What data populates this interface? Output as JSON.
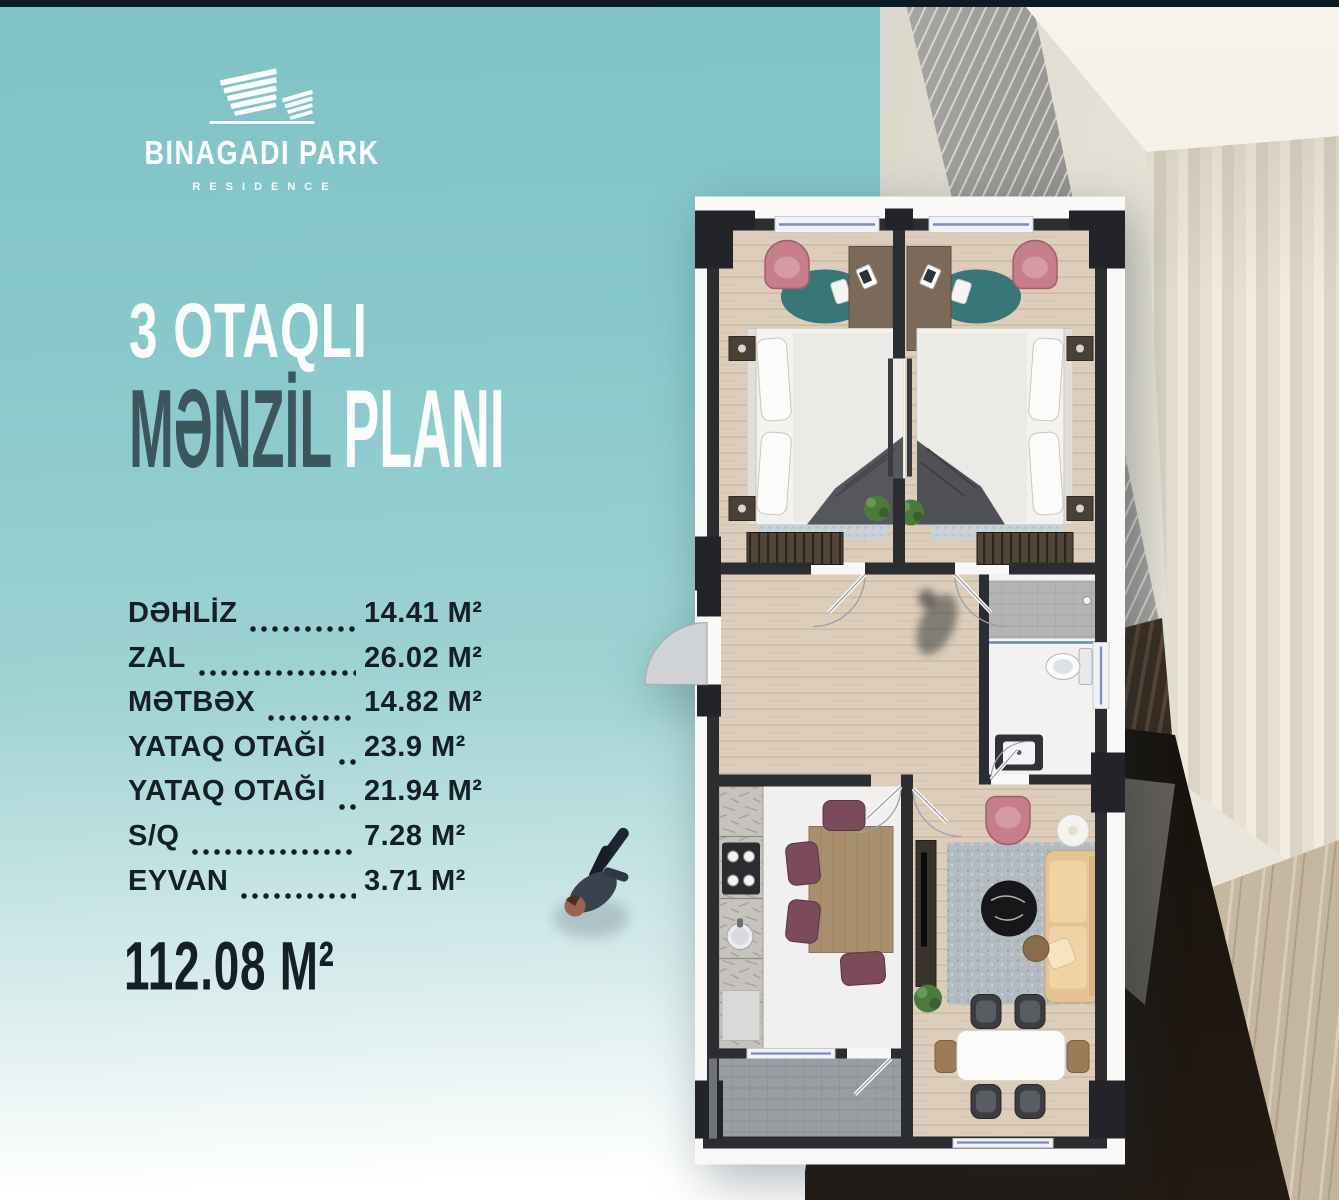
{
  "brand": {
    "name": "BINAGADI PARK",
    "subtitle": "RESIDENCE"
  },
  "headline": {
    "line1": "3 OTAQLI",
    "line2_primary": "MƏNZİL",
    "line2_secondary": "PLANI"
  },
  "rooms": [
    {
      "label": "DƏHLİZ",
      "value": "14.41 M²"
    },
    {
      "label": "ZAL",
      "value": "26.02 M²"
    },
    {
      "label": "MƏTBƏX",
      "value": "14.82 M²"
    },
    {
      "label": "YATAQ OTAĞI",
      "value": "23.9 M²"
    },
    {
      "label": "YATAQ OTAĞI",
      "value": "21.94 M²"
    },
    {
      "label": "S/Q",
      "value": "7.28 M²"
    },
    {
      "label": "EYVAN",
      "value": "3.71 M²"
    }
  ],
  "total": {
    "value": "112.08 M²"
  },
  "colors": {
    "background_teal": "#85c6ca",
    "headline_light": "#fbfdfd",
    "headline_dark": "#3b565c",
    "text_dark": "#141f27",
    "plan_wall": "#2c2d31",
    "accent_pink": "#c57e8a",
    "wood_floor": "#ddcdbb"
  }
}
